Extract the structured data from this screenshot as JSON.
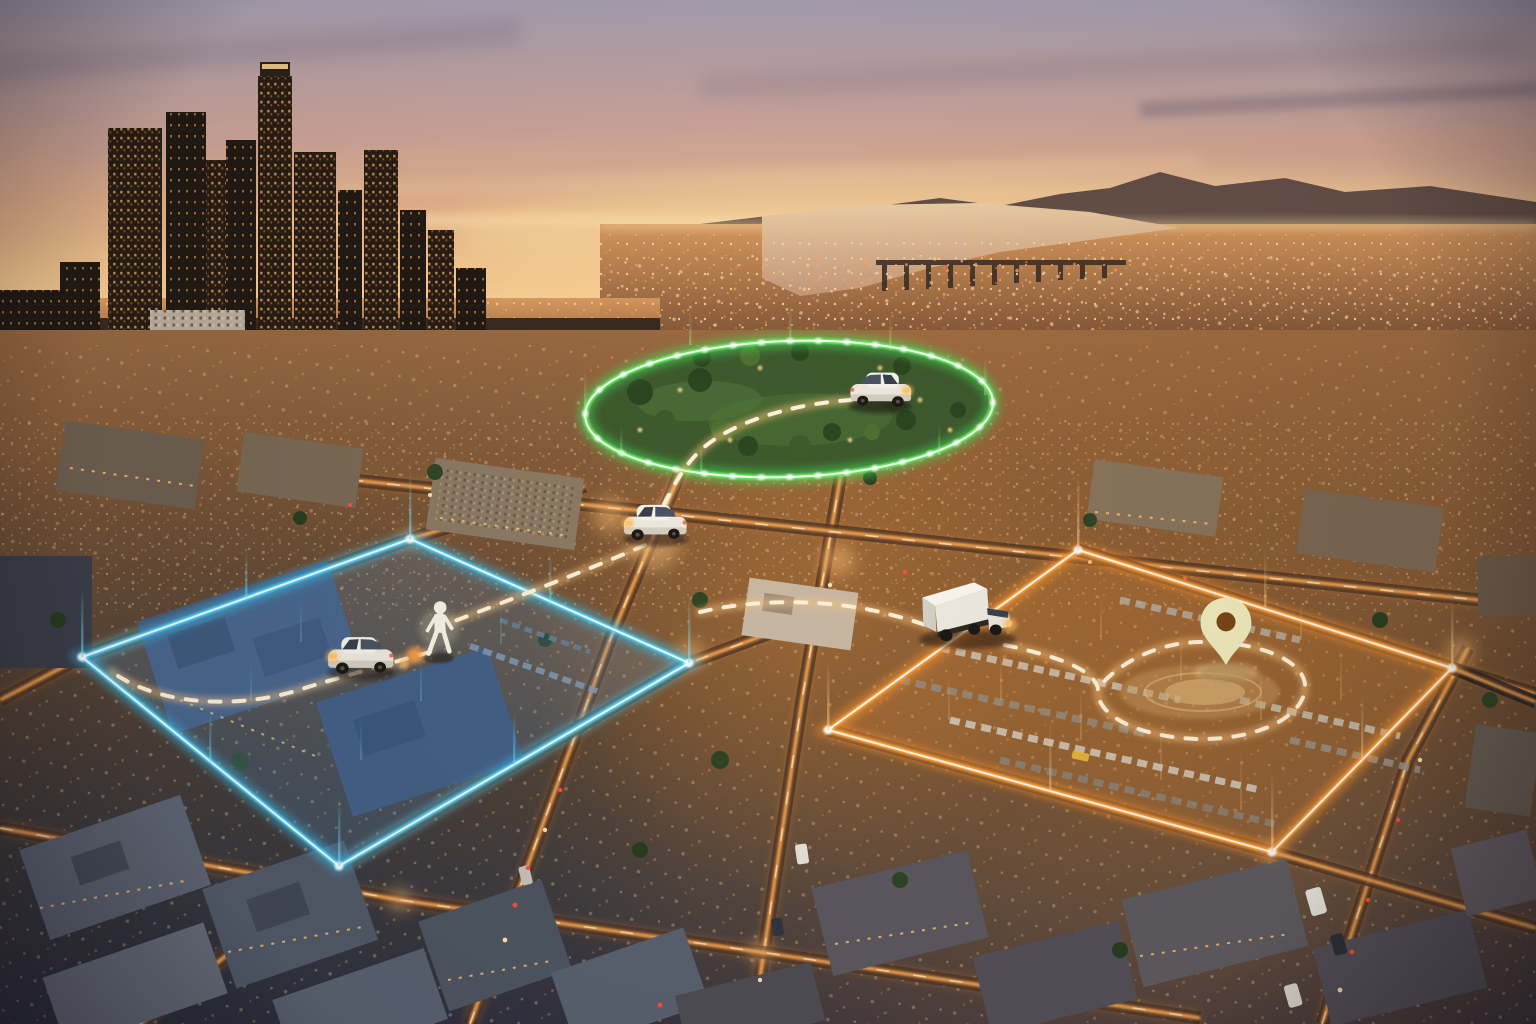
{
  "scene": {
    "type": "aerial-cityscape",
    "time_of_day": "dusk",
    "description": "Aerial view of a city at sunset with three glowing geofence zones (green park ellipse, blue city-block quad, orange parking-lot quad), tracked white vehicles, a pedestrian and a destination pin linked by dashed tracking routes",
    "skyline": "downtown high-rise cluster left, hazy bay with bridge and mountains upper right"
  },
  "colors": {
    "sky_top": "#a8a0b2",
    "sky_mid": "#e4b18c",
    "sky_horizon": "#fbd9a2",
    "mountains": "#5e4a42",
    "water": "#e9c7a0",
    "far_city": "#c98f58",
    "window_light": "#ffc46e",
    "street_glow": "#ffab55",
    "ground_warm": "#7b5636",
    "ground_cool": "#343340",
    "zone_green": "#6ef06a",
    "zone_blue": "#55d8ff",
    "zone_orange": "#ffa63d",
    "route_dash": "#fff1d8",
    "vehicle_body": "#eee9de",
    "truck_body": "#efebe0",
    "pin_fill": "#f2ecbe",
    "pin_hole": "#7c4617"
  },
  "zones": [
    {
      "id": "park-geofence",
      "shape": "ellipse",
      "color_key": "zone_green",
      "center": {
        "x": 789,
        "y": 409
      },
      "radius_x": 204,
      "radius_y": 68,
      "area": "city park with trees",
      "occupants": [
        "car-in-park"
      ]
    },
    {
      "id": "block-geofence",
      "shape": "quadrilateral",
      "color_key": "zone_blue",
      "corners": [
        [
          410,
          539
        ],
        [
          689,
          663
        ],
        [
          339,
          866
        ],
        [
          82,
          657
        ]
      ],
      "area": "city block with flat-roof buildings",
      "occupants": [
        "car-in-block",
        "pedestrian"
      ]
    },
    {
      "id": "parking-geofence",
      "shape": "quadrilateral",
      "color_key": "zone_orange",
      "corners": [
        [
          1078,
          550
        ],
        [
          1452,
          668
        ],
        [
          1272,
          852
        ],
        [
          828,
          730
        ]
      ],
      "area": "parking lot with rows of parked cars",
      "occupants": [
        "delivery-truck",
        "destination-pin"
      ]
    }
  ],
  "entities": [
    {
      "id": "car-in-park",
      "icon": "car-icon",
      "position": {
        "x": 878,
        "y": 392
      },
      "heading": "southwest"
    },
    {
      "id": "car-on-street",
      "icon": "car-icon",
      "position": {
        "x": 655,
        "y": 522
      },
      "heading": "southwest"
    },
    {
      "id": "car-in-block",
      "icon": "car-icon",
      "position": {
        "x": 360,
        "y": 656
      },
      "heading": "southwest"
    },
    {
      "id": "pedestrian",
      "icon": "person-icon",
      "position": {
        "x": 439,
        "y": 634
      },
      "state": "walking"
    },
    {
      "id": "delivery-truck",
      "icon": "truck-icon",
      "position": {
        "x": 968,
        "y": 614
      },
      "heading": "southeast"
    },
    {
      "id": "destination-pin",
      "icon": "map-pin-icon",
      "position": {
        "x": 1226,
        "y": 665
      }
    }
  ],
  "routes": [
    {
      "id": "park-to-street",
      "style": "dashed",
      "from": "car-in-park",
      "to": "car-on-street"
    },
    {
      "id": "street-to-pedestrian",
      "style": "dashed",
      "from": "car-on-street",
      "to": "pedestrian"
    },
    {
      "id": "pedestrian-to-block-car",
      "style": "dashed",
      "from": "pedestrian",
      "to": "block-geofence-west-corner"
    },
    {
      "id": "block-to-truck",
      "style": "dashed",
      "from": "block-geofence",
      "to": "delivery-truck"
    },
    {
      "id": "truck-loop",
      "style": "dashed",
      "from": "delivery-truck",
      "to": "destination-pin",
      "note": "loops around plaza below the pin"
    }
  ]
}
